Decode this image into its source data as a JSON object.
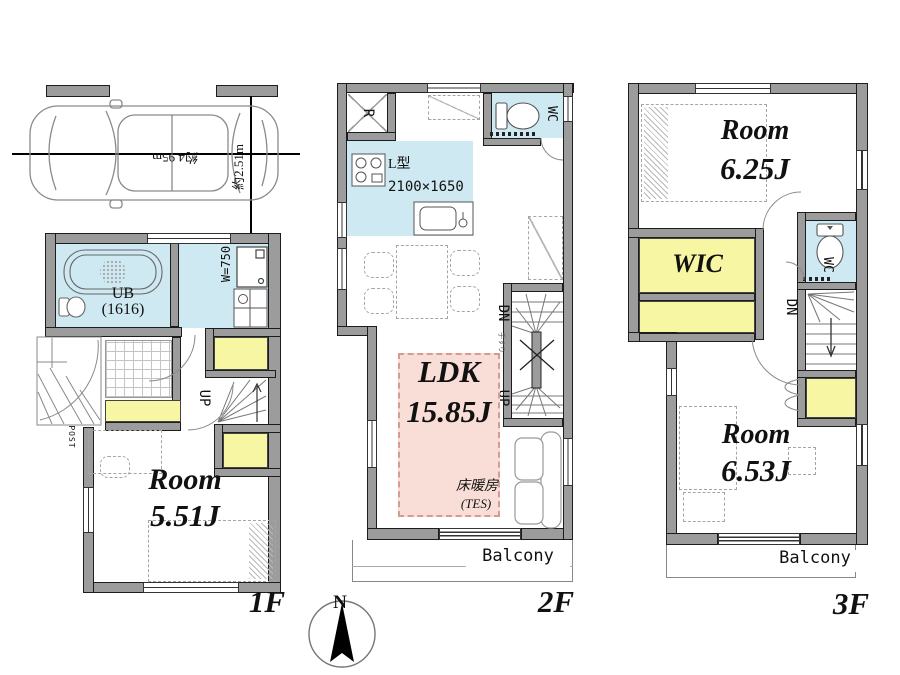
{
  "title": "3-story house floor plan",
  "colors": {
    "wall": "#9c9c9c",
    "wet_area": "#cfe9f2",
    "storage": "#f7f7a3",
    "ldk_fill": "#f9ded8"
  },
  "compass": {
    "north": "N"
  },
  "floor1": {
    "floor_label": "1F",
    "parking": {
      "width": "約4.95m",
      "depth": "約2.51m"
    },
    "bath": {
      "name": "UB",
      "size": "(1616)"
    },
    "washer_width": "W=750",
    "post": "POST",
    "stairs_up": "UP",
    "room": {
      "name": "Room",
      "size": "5.51J"
    }
  },
  "floor2": {
    "floor_label": "2F",
    "refrigerator": "R",
    "toilet_room": "WC",
    "kitchen": {
      "type": "L型",
      "size": "2100×1650"
    },
    "stairs_down": "DN",
    "stairs_up": "UP",
    "handrail": "手すり",
    "ldk": {
      "name": "LDK",
      "size": "15.85J"
    },
    "floor_heating": {
      "name": "床暖房",
      "system": "(TES)"
    },
    "balcony": "Balcony"
  },
  "floor3": {
    "floor_label": "3F",
    "room_front": {
      "name": "Room",
      "size": "6.25J"
    },
    "closet": "WIC",
    "toilet_room": "WC",
    "stairs_down": "DN",
    "room_back": {
      "name": "Room",
      "size": "6.53J"
    },
    "balcony": "Balcony"
  }
}
